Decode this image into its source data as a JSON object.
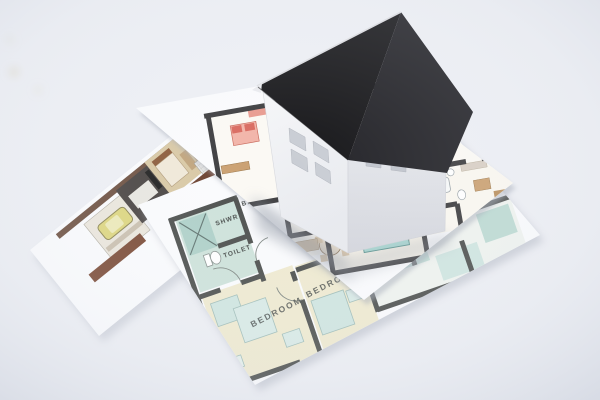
{
  "scene": {
    "type": "photograph",
    "subject": "White paper model house with black roof standing on printed architectural floor plans",
    "background_color": "#edeff4"
  },
  "house": {
    "roof_color": "#17171a",
    "roof_side_color": "#232328",
    "roof_edge_color": "#dcdde1",
    "wall_color": "#f3f4f6",
    "wall_shade_color": "#dfe1e6",
    "window_color": "#c9cdd4",
    "window_shade_color": "#c0c4cc",
    "windows_left_wall": 4,
    "windows_right_wall": 4
  },
  "sheets": {
    "paper_color": "#fafbfd",
    "front_plan": {
      "labels": {
        "shower": "SHWR",
        "bath_fragment": "BA",
        "toilet": "TOILET",
        "bedroom_main": "BEDROOM",
        "bedroom_second": "BEDROOM"
      },
      "wall_color": "#4c4f4d",
      "floor_color": "#efead0",
      "tile_color": "#cde2da",
      "shower_tile_color": "#aed0c8",
      "furniture_teal": "#cfe5e0",
      "room_teal": "#c2ded6"
    },
    "middle_plan": {
      "wall_color": "#3c3c3e",
      "bed_pink": "#f2b4a8",
      "pillow_red": "#d96a5f",
      "bed_teal": "#a8d8d2",
      "wood_tan": "#caa070",
      "wood_dark": "#6b4a33",
      "plant_green": "#7f9f52",
      "counter_beige": "#ded2c2",
      "table_cream": "#e9ddca",
      "tub_white": "#f7f9f9"
    },
    "left_renderings": {
      "car_body": "#ddd57e",
      "car_roof": "#eceab8",
      "garage_floor": "#eae6dc",
      "dark_room": "#474240",
      "bedroom_tan": "#d8c8a4",
      "top_room_tan": "#cdb392",
      "accent_red": "#a84a38",
      "band_brown": "#5c3c2a",
      "deck_brown": "#7a4a35"
    }
  }
}
